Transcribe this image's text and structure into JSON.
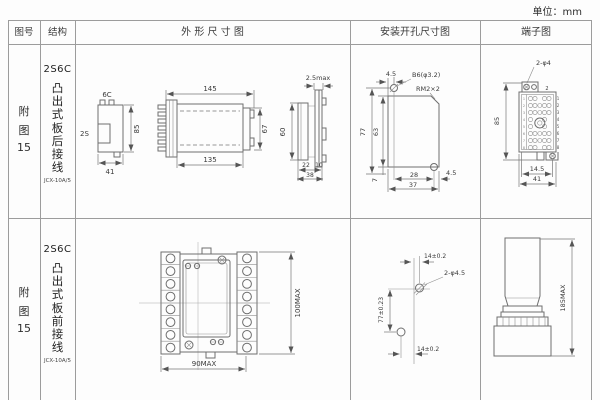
{
  "unit_label": "单位：mm",
  "header": {
    "figure_no": "图号",
    "structure": "结构",
    "outline": "外 形 尺 寸 图",
    "install": "安装开孔尺寸图",
    "terminal": "端子图"
  },
  "rows": [
    {
      "figure": {
        "l1": "附",
        "l2": "图",
        "l3": "15"
      },
      "structure": {
        "model": "2S6C",
        "desc": "凸出式板后接线",
        "code": "JCX-10A/5"
      },
      "outline": {
        "label_6c": "6C",
        "label_2s": "2S",
        "h85": "85",
        "w41": "41",
        "w145": "145",
        "w135": "135",
        "h67": "67",
        "t25": "2.5max",
        "h60": "60",
        "w22": "22",
        "w10": "10",
        "w38": "38"
      },
      "install": {
        "t45": "4.5",
        "hole": "B6(φ3.2)",
        "corner": "RM2×2",
        "h77": "77",
        "h63": "63",
        "h7": "7",
        "w28": "28",
        "r45": "4.5",
        "w37": "37"
      },
      "terminal": {
        "hole": "2-φ4",
        "h85": "85",
        "w145": "14.5",
        "w41": "41",
        "top_no": "2",
        "pins": [
          "1",
          "2",
          "3",
          "4",
          "5",
          "6",
          "7",
          "8"
        ]
      }
    },
    {
      "figure": {
        "l1": "附",
        "l2": "图",
        "l3": "15"
      },
      "structure": {
        "model": "2S6C",
        "desc": "凸出式板前接线",
        "code": "JCX-10A/5"
      },
      "outline": {
        "h100": "100MAX",
        "w90": "90MAX"
      },
      "install": {
        "t14": "14±0.2",
        "hole": "2-φ4.5",
        "h77": "77±0.23",
        "b14": "14±0.2"
      },
      "terminal": {
        "h185": "185MAX"
      }
    }
  ]
}
